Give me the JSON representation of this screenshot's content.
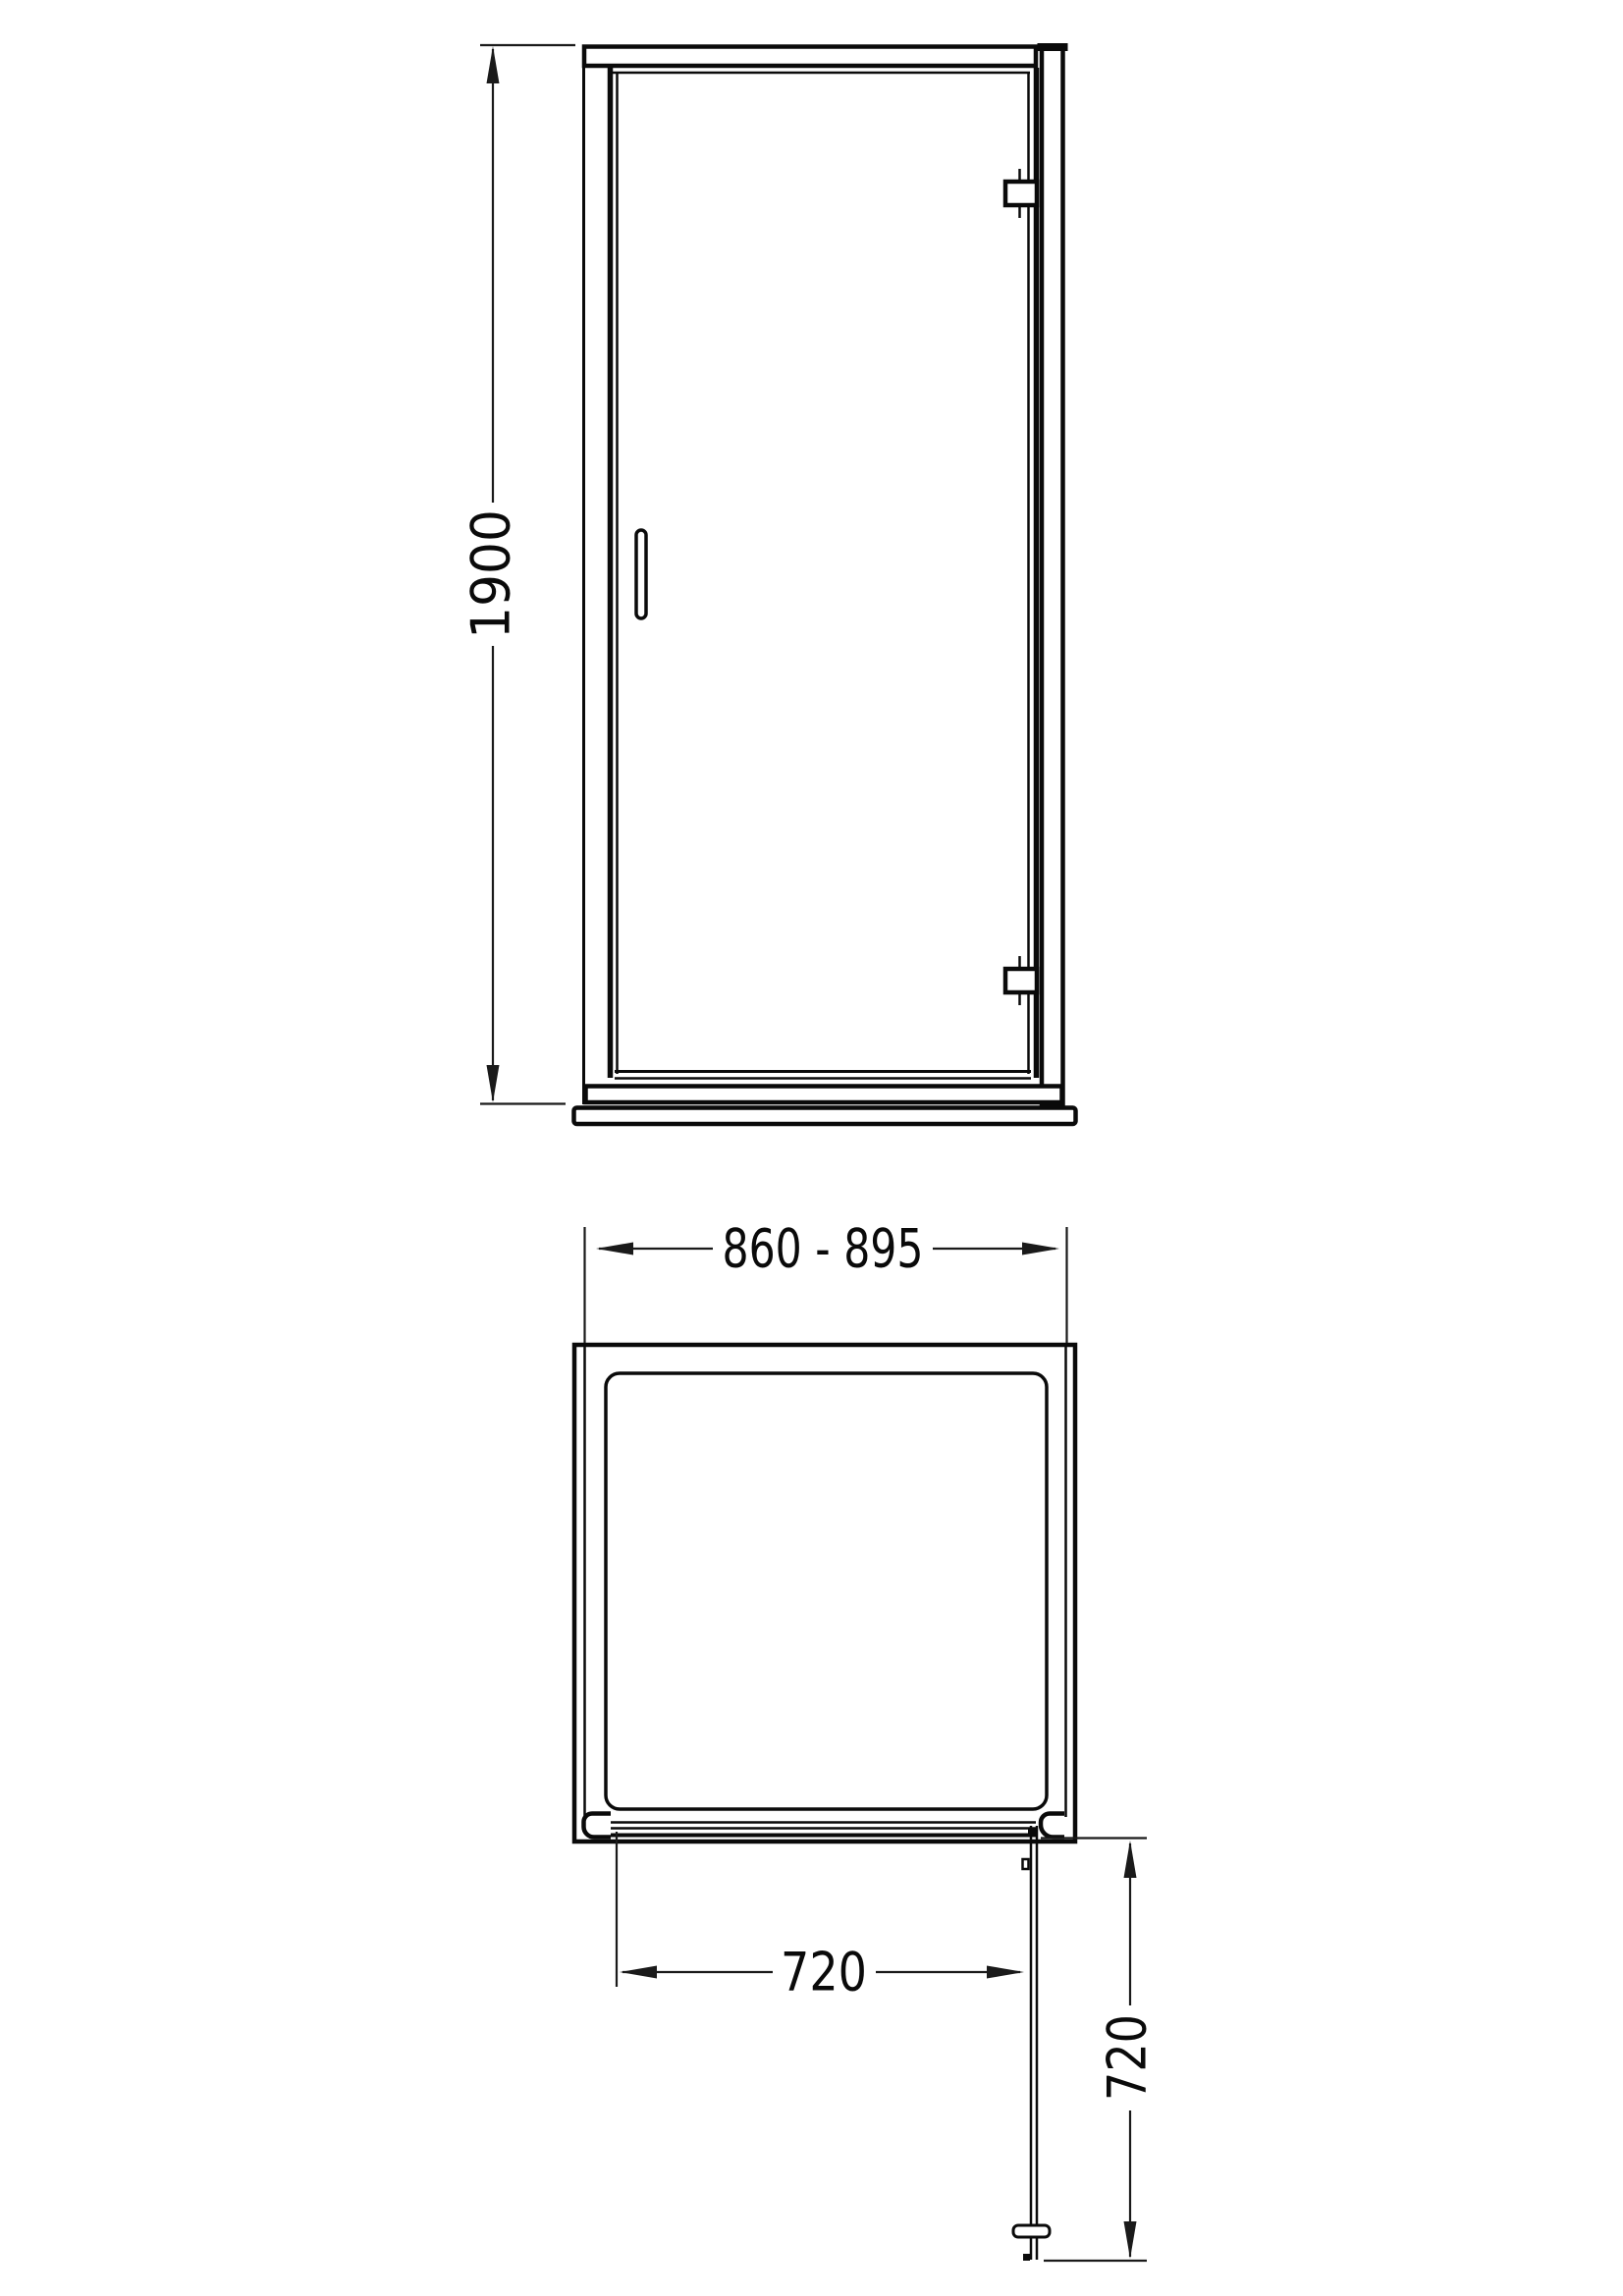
{
  "colors": {
    "background": "#ffffff",
    "line": "#0a0a0a"
  },
  "front_view": {
    "height_dimension": "1900"
  },
  "plan_view": {
    "width_dimension": "860 - 895",
    "opening_dimension": "720",
    "projection_dimension": "720"
  }
}
